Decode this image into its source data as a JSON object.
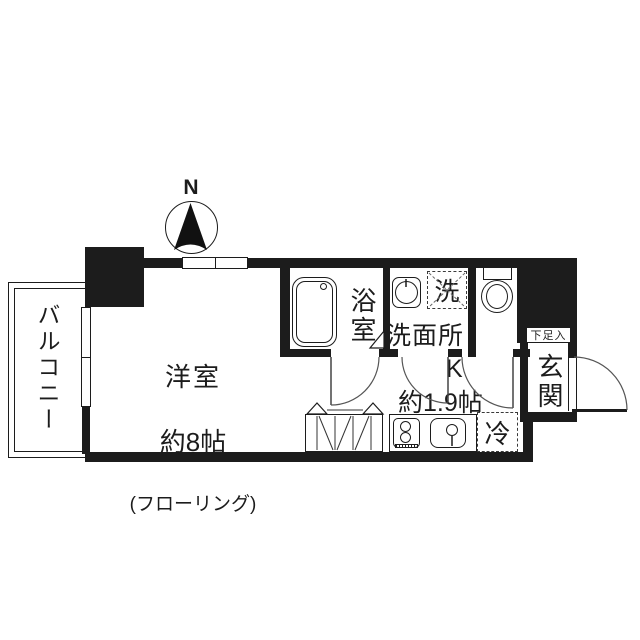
{
  "title": "apartment-floor-plan",
  "compass": {
    "north_label": "N"
  },
  "rooms": {
    "balcony": {
      "label": "バルコニー"
    },
    "main_room": {
      "name": "洋室",
      "size": "約8帖",
      "note": "(フローリング)"
    },
    "bathroom": {
      "label": "浴室"
    },
    "washroom": {
      "label": "洗面所",
      "washer_space_label": "洗"
    },
    "toilet": {
      "label": ""
    },
    "kitchen": {
      "label": "K",
      "size": "約1.9帖",
      "fridge_space_label": "冷"
    },
    "entrance": {
      "label": "玄関",
      "shoe_cabinet_label": "下足入"
    }
  },
  "icons": {
    "compass": "compass-north-needle",
    "bathtub": "bathtub-icon",
    "vanity": "sink-basin-icon",
    "toilet": "toilet-icon",
    "stove": "two-burner-stove-icon",
    "kitchen_sink": "kitchen-sink-icon",
    "closet": "folding-door-closet-icon"
  },
  "colors": {
    "wall": "#1c1c1c",
    "line": "#444444",
    "background": "#ffffff"
  }
}
